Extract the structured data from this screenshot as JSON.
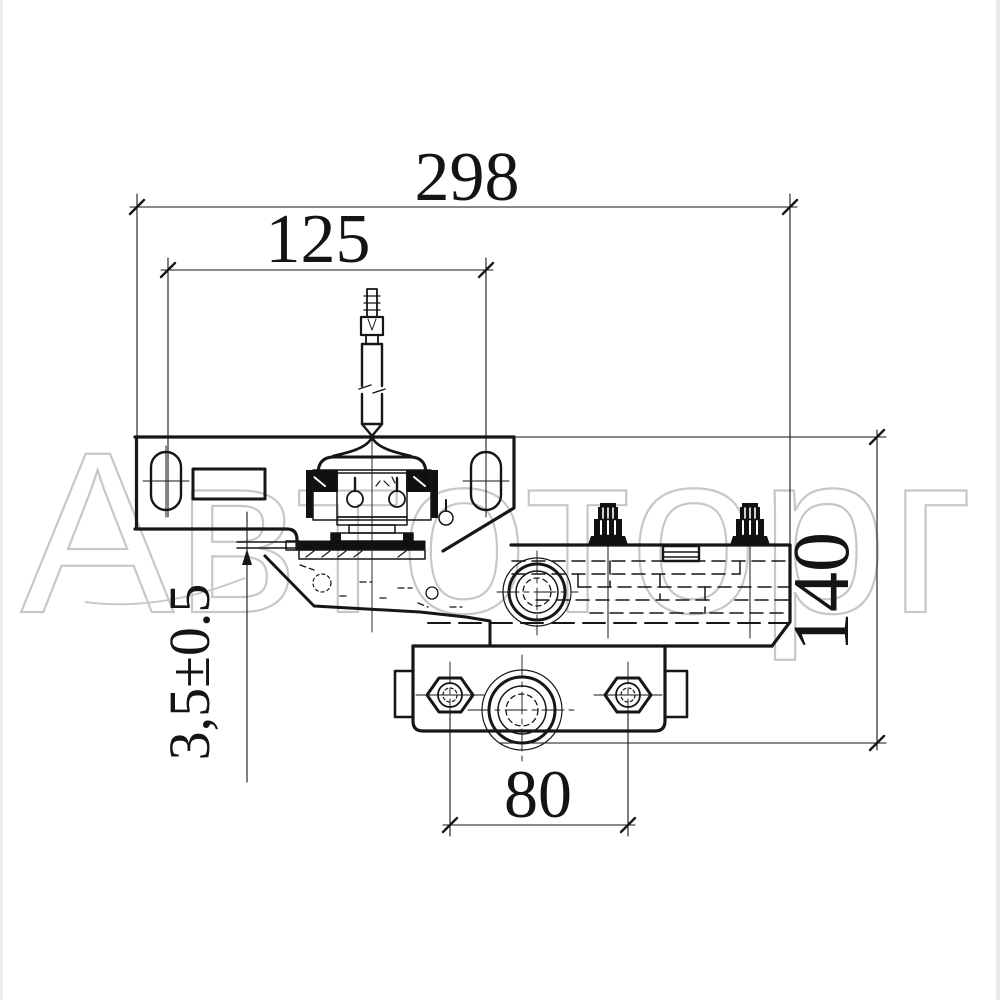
{
  "drawing": {
    "title": "door closer / latch mechanism technical drawing, front view",
    "watermark": {
      "text": "Автоторг",
      "color": "#c7c7c7"
    },
    "dimensions": {
      "total_width": "298",
      "upper_slot_spacing": "125",
      "total_height": "140",
      "lower_bolt_spacing": "80",
      "gap_tolerance": "3,5±0.5"
    },
    "colors": {
      "ink": "#161616",
      "background": "#ffffff"
    }
  }
}
